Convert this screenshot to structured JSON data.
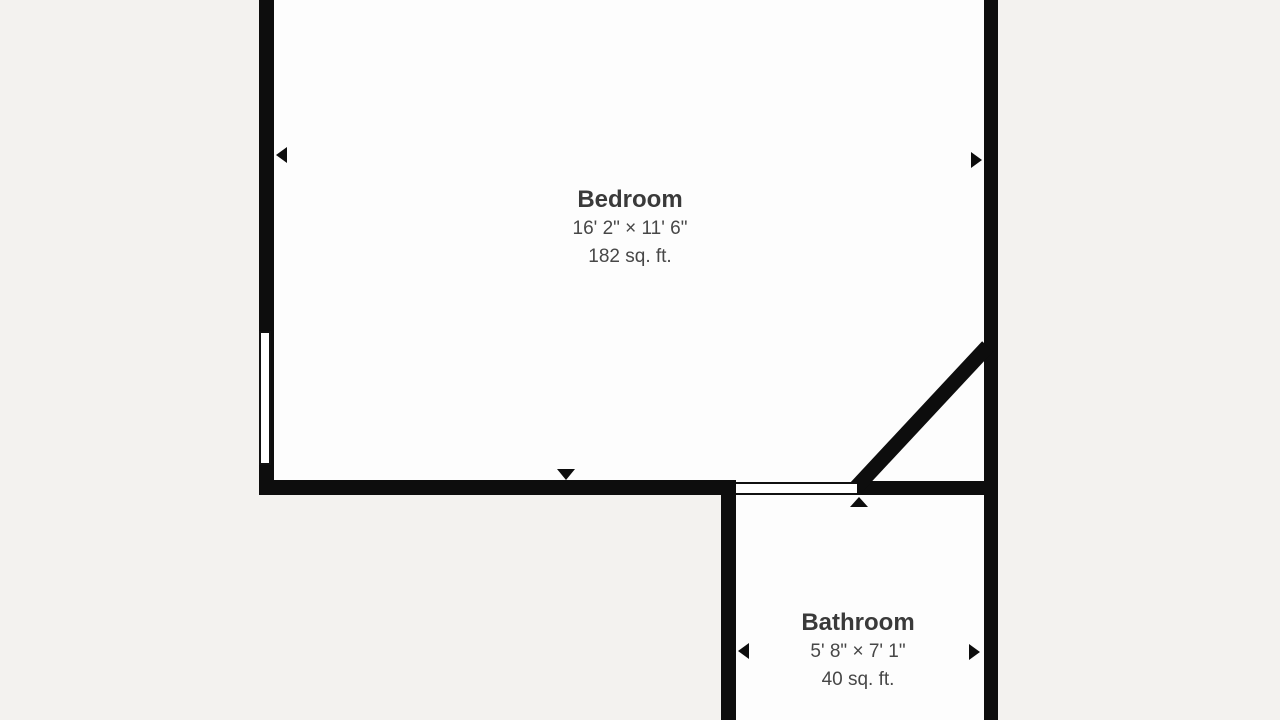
{
  "floor_plan": {
    "rooms": [
      {
        "name": "Bedroom",
        "dimensions": "16' 2\" × 11' 6\"",
        "area": "182 sq. ft."
      },
      {
        "name": "Bathroom",
        "dimensions": "5' 8\" × 7' 1\"",
        "area": "40 sq. ft."
      }
    ],
    "features": {
      "window_count": 1,
      "door_opening_count": 1,
      "wall_markers": [
        "triangle-left",
        "triangle-right",
        "triangle-down",
        "triangle-up",
        "triangle-left",
        "triangle-right"
      ]
    },
    "colors": {
      "background": "#f3f2ef",
      "room_fill": "#fdfdfd",
      "wall": "#0d0d0d",
      "room_name_text": "#3a3a3a",
      "room_detail_text": "#474747"
    }
  }
}
